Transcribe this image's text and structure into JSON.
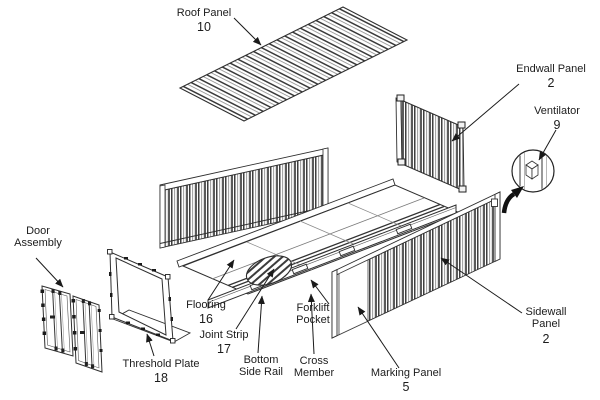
{
  "diagram": {
    "kind": "exploded-parts-line-drawing",
    "colors": {
      "line": "#2f2f2f",
      "background": "#ffffff",
      "text": "#1c1c1c"
    }
  },
  "labels": {
    "roof_panel": {
      "text": "Roof Panel",
      "number": "10"
    },
    "endwall_panel": {
      "text": "Endwall Panel",
      "number": "2"
    },
    "ventilator": {
      "text": "Ventilator",
      "number": "9"
    },
    "door_assembly": {
      "line1": "Door",
      "line2": "Assembly"
    },
    "flooring": {
      "text": "Flooring",
      "number": "16"
    },
    "joint_strip": {
      "text": "Joint Strip",
      "number": "17"
    },
    "bottom_side_rail": {
      "line1": "Bottom",
      "line2": "Side Rail"
    },
    "cross_member": {
      "line1": "Cross",
      "line2": "Member"
    },
    "forklift_pocket": {
      "line1": "Forklift",
      "line2": "Pocket"
    },
    "marking_panel": {
      "text": "Marking Panel",
      "number": "5"
    },
    "sidewall_panel": {
      "line1": "Sidewall",
      "line2": "Panel",
      "number": "2"
    },
    "threshold_plate": {
      "text": "Threshold Plate",
      "number": "18"
    }
  }
}
